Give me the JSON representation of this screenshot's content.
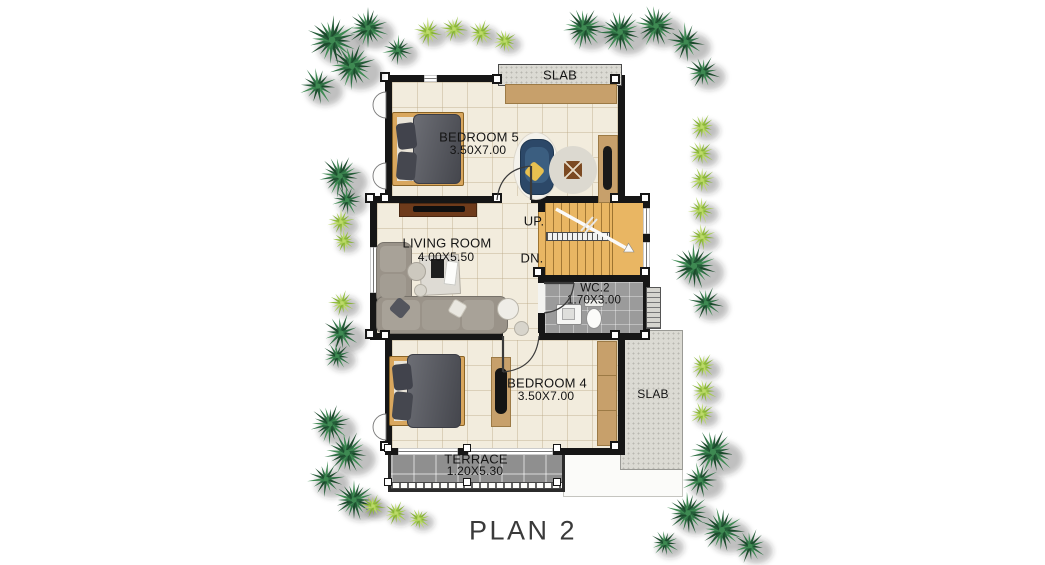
{
  "title": "PLAN 2",
  "labels": {
    "slab_top": "SLAB",
    "slab_right": "SLAB",
    "stairs_up": "UP.",
    "stairs_down": "DN."
  },
  "rooms": {
    "bedroom5": {
      "name": "BEDROOM 5",
      "dims": "3.50X7.00"
    },
    "living": {
      "name": "LIVING ROOM",
      "dims": "4.00X5.50"
    },
    "wc2": {
      "name": "WC.2",
      "dims": "1.70X3.00"
    },
    "bedroom4": {
      "name": "BEDROOM 4",
      "dims": "3.50X7.00"
    },
    "terrace": {
      "name": "TERRACE",
      "dims": "1.20X5.30"
    }
  },
  "colors": {
    "wall": "#161616",
    "floor": "#f2ecdd",
    "wood_stairs": "#e9b663",
    "tile_gray": "#9b9b9b",
    "terrace_gray": "#8f8f8f",
    "slab": "#dbdad3",
    "furniture_wood": "#d9a75e",
    "closet_wood": "#c7a06b",
    "blanket": "#54565e",
    "sofa": "#9a9389",
    "accent_chair": "#2c4868",
    "accent_pillow": "#e7c050",
    "plant_dark": "#2e6b42",
    "plant_light": "#a4c94e"
  }
}
